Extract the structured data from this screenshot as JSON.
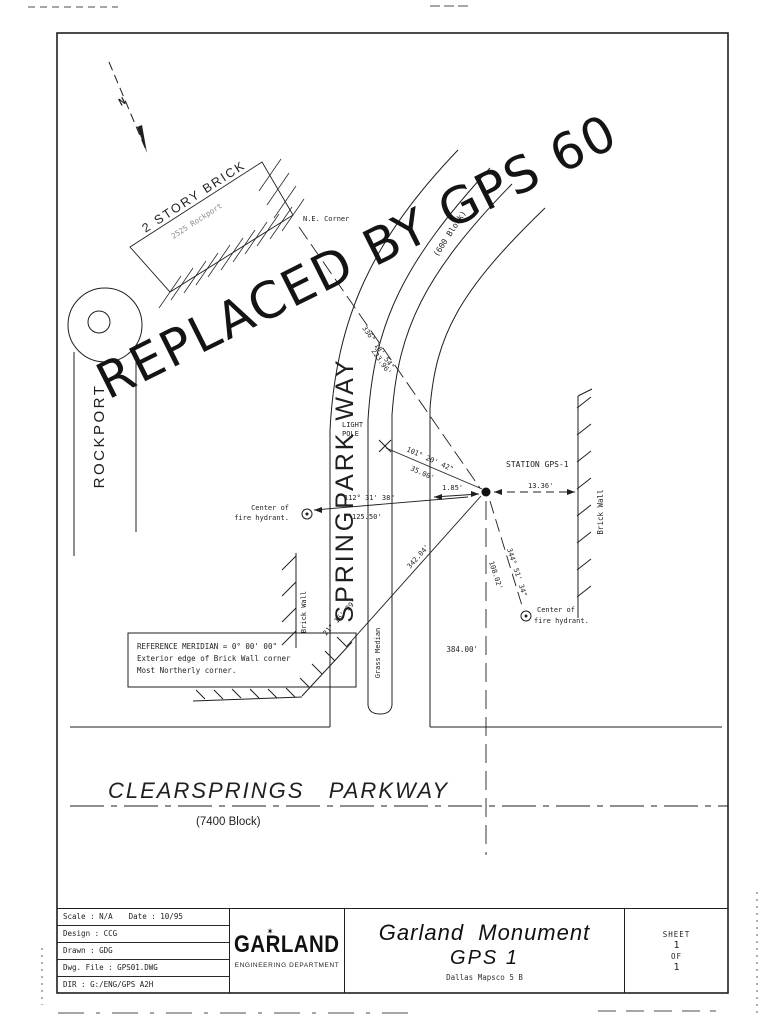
{
  "drawing": {
    "north": "N",
    "building": {
      "label": "2 STORY BRICK",
      "address": "2525 Rockport",
      "corner": "N.E. Corner"
    },
    "streets": {
      "rockport": "ROCKPORT",
      "springpark": "SPRINGPARK WAY",
      "springpark_block": "(600 Block)",
      "clearsprings": "CLEARSPRINGS   PARKWAY",
      "clearsprings_block": "(7400 Block)",
      "median": "Grass Median"
    },
    "stamp": "REPLACED BY GPS 60",
    "station": "STATION GPS-1",
    "light_pole": {
      "line1": "LIGHT",
      "line2": "POLE"
    },
    "walls": {
      "right": "Brick Wall",
      "left": "Brick Wall"
    },
    "hydrants": {
      "left1": "Center of",
      "left2": "fire hydrant.",
      "right1": "Center of",
      "right2": "fire hydrant."
    },
    "measurements": {
      "ne_angle": "336° 18' 54\"",
      "ne_dist": "223.96'",
      "pole_angle": "101° 20' 42\"",
      "pole_dist": "35.00'",
      "west_angle": "112° 31' 38\"",
      "west_dist": "125.50'",
      "offset": "1.85'",
      "east": "13.36'",
      "se_angle": "344° 51' 34\"",
      "se_dist": "108.02'",
      "sw_angle": "21° 16' 39\"",
      "sw_dist": "342.04'",
      "south": "384.00'"
    },
    "reference_note": {
      "line1": "REFERENCE MERIDIAN = 0° 00' 00\"",
      "line2": "Exterior edge of Brick Wall corner",
      "line3": "Most Northerly corner."
    }
  },
  "title_block": {
    "scale": "Scale : N/A",
    "date": "Date : 10/95",
    "design": "Design : CCG",
    "drawn": "Drawn : GDG",
    "file": "Dwg. File : GPS01.DWG",
    "dir": "DIR : G:/ENG/GPS A2H",
    "logo": "GARLAND",
    "dept": "ENGINEERING DEPARTMENT",
    "title1": "Garland  Monument",
    "title2": "GPS 1",
    "subtitle": "Dallas Mapsco 5 B",
    "sheet_label": "SHEET",
    "sheet_no": "1",
    "of_label": "OF",
    "of_total": "1"
  },
  "icons": {
    "star": "✶"
  }
}
